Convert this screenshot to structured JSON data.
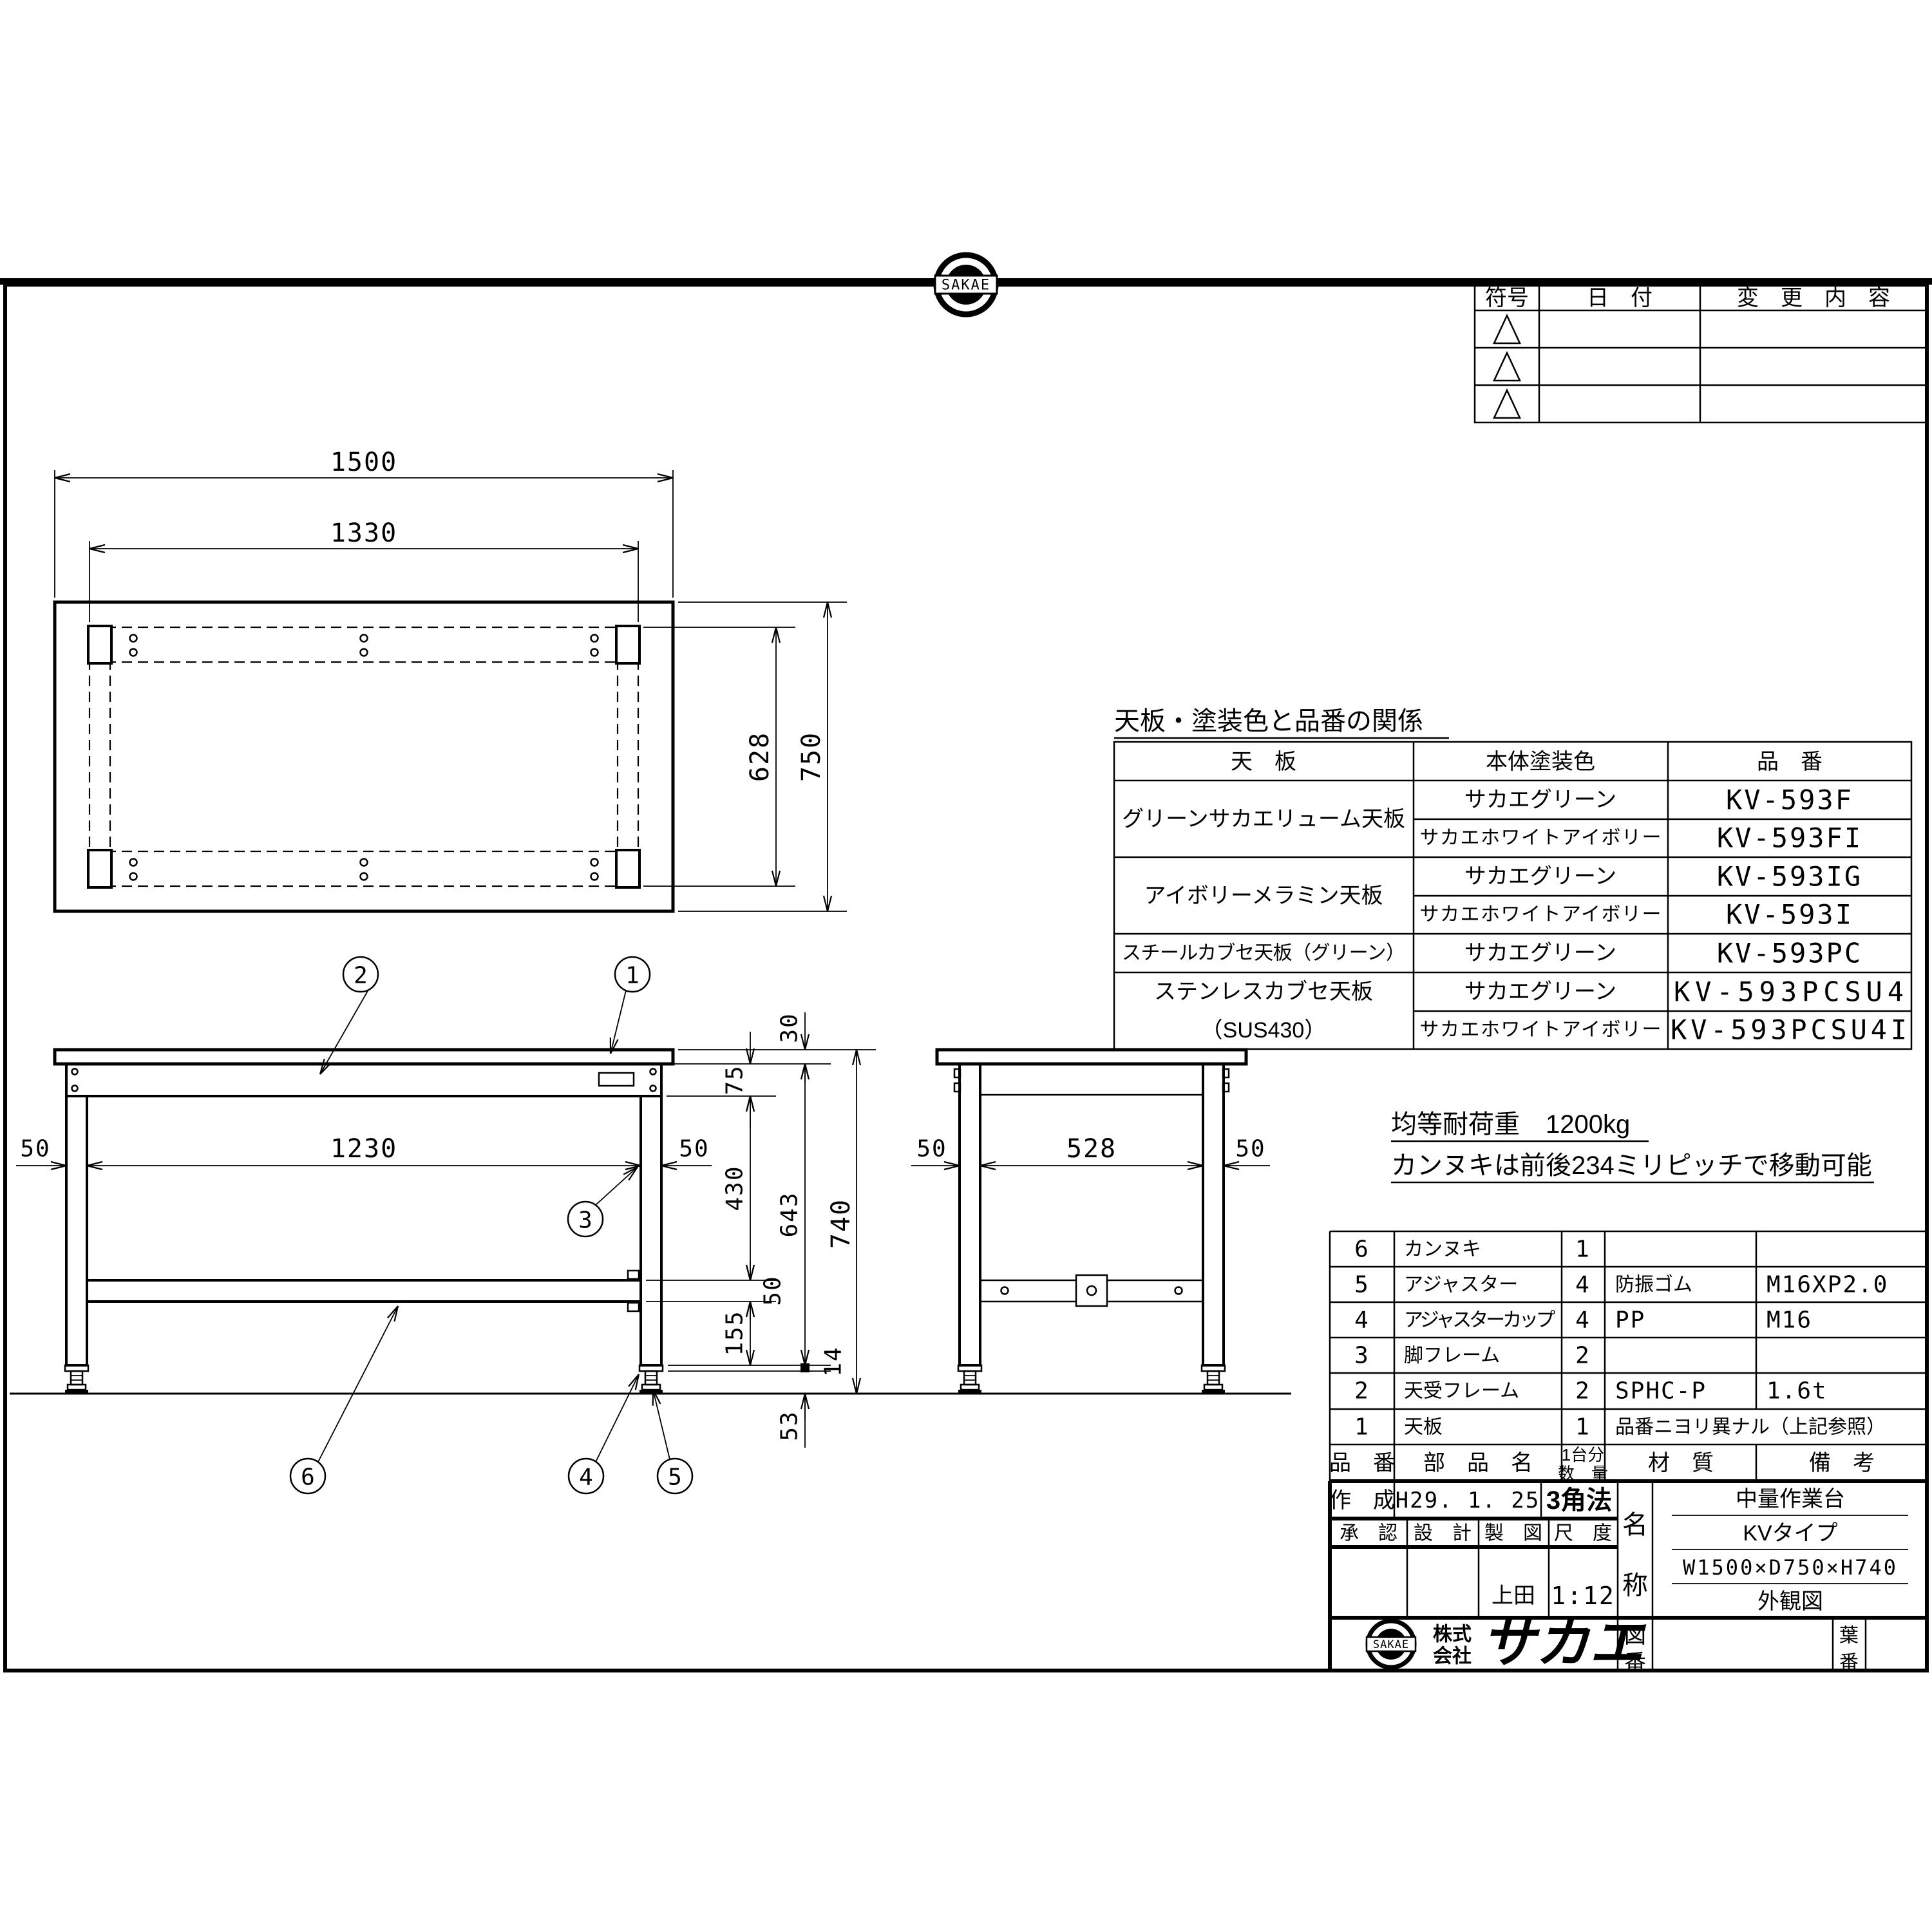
{
  "sheet": {
    "bg": "#ffffff",
    "line_color": "#000000"
  },
  "top_logo": {
    "label": "SAKAE"
  },
  "revision_table": {
    "col_symbol": "符号",
    "col_date": "日　付",
    "col_change": "変　更　内　容"
  },
  "color_table": {
    "title": "天板・塗装色と品番の関係",
    "col_top_plate": "天　板",
    "col_body_color": "本体塗装色",
    "col_part_no": "品　番",
    "groups": [
      {
        "plate": "グリーンサカエリューム天板",
        "rows": [
          {
            "coat": "サカエグリーン",
            "part": "KV-593F"
          },
          {
            "coat": "サカエホワイトアイボリー",
            "part": "KV-593FI"
          }
        ]
      },
      {
        "plate": "アイボリーメラミン天板",
        "rows": [
          {
            "coat": "サカエグリーン",
            "part": "KV-593IG"
          },
          {
            "coat": "サカエホワイトアイボリー",
            "part": "KV-593I"
          }
        ]
      },
      {
        "plate": "スチールカブセ天板（グリーン）",
        "rows": [
          {
            "coat": "サカエグリーン",
            "part": "KV-593PC"
          }
        ]
      },
      {
        "plate_l1": "ステンレスカブセ天板",
        "plate_l2": "（SUS430）",
        "rows": [
          {
            "coat": "サカエグリーン",
            "part": "KV-593PCSU4"
          },
          {
            "coat": "サカエホワイトアイボリー",
            "part": "KV-593PCSU4I"
          }
        ]
      }
    ]
  },
  "notes": {
    "line1": "均等耐荷重　1200kg",
    "line2": "カンヌキは前後234ミリピッチで移動可能"
  },
  "parts_table": {
    "header": {
      "no": "品　番",
      "name": "部　品　名",
      "qty_l1": "1台分",
      "qty_l2": "数　量",
      "material": "材　質",
      "remark": "備　考"
    },
    "rows": [
      {
        "no": "6",
        "name": "カンヌキ",
        "qty": "1",
        "material": "",
        "remark": ""
      },
      {
        "no": "5",
        "name": "アジャスター",
        "qty": "4",
        "material": "防振ゴム",
        "remark": "M16XP2.0"
      },
      {
        "no": "4",
        "name": "アジャスターカップ",
        "qty": "4",
        "material": "PP",
        "remark": "M16"
      },
      {
        "no": "3",
        "name": "脚フレーム",
        "qty": "2",
        "material": "",
        "remark": ""
      },
      {
        "no": "2",
        "name": "天受フレーム",
        "qty": "2",
        "material": "SPHC-P",
        "remark": "1.6t"
      },
      {
        "no": "1",
        "name": "天板",
        "qty": "1",
        "material": "品番ニヨリ異ナル（上記参照）",
        "remark": ""
      }
    ]
  },
  "title_block": {
    "created_label": "作　成",
    "created_date": "H29. 1. 25",
    "projection": "3角法",
    "approve": "承　認",
    "design": "設　計",
    "draft": "製　図",
    "scale_label": "尺　度",
    "drafter": "上田",
    "scale": "1:12",
    "name_label_l1": "名",
    "name_label_l2": "称",
    "name_rows": [
      "中量作業台",
      "KVタイプ",
      "W1500×D750×H740",
      "外観図"
    ],
    "company_prefix_l1": "株式",
    "company_prefix_l2": "会社",
    "company_logotype": "サカエ",
    "company_logo_text": "SAKAE",
    "dwg_no_l1": "図",
    "dwg_no_l2": "番",
    "sheet_no_l1": "葉",
    "sheet_no_l2": "番"
  },
  "views": {
    "plan": {
      "dim_width": "1500",
      "dim_inner_width": "1330",
      "dim_inner_depth": "628",
      "dim_depth": "750"
    },
    "front": {
      "dim_leg_left": "50",
      "dim_span": "1230",
      "dim_leg_right": "50",
      "dim_top_thick": "30",
      "dim_apron": "75",
      "dim_apron_to_rail": "430",
      "dim_rail": "50",
      "dim_rail_to_floor": "155",
      "dim_leg_total": "643",
      "dim_height": "740",
      "dim_plate": "14",
      "dim_adjuster": "53"
    },
    "side": {
      "dim_leg_left": "50",
      "dim_span": "528",
      "dim_leg_right": "50"
    },
    "balloons": {
      "b1": "1",
      "b2": "2",
      "b3": "3",
      "b4": "4",
      "b5": "5",
      "b6": "6"
    }
  }
}
